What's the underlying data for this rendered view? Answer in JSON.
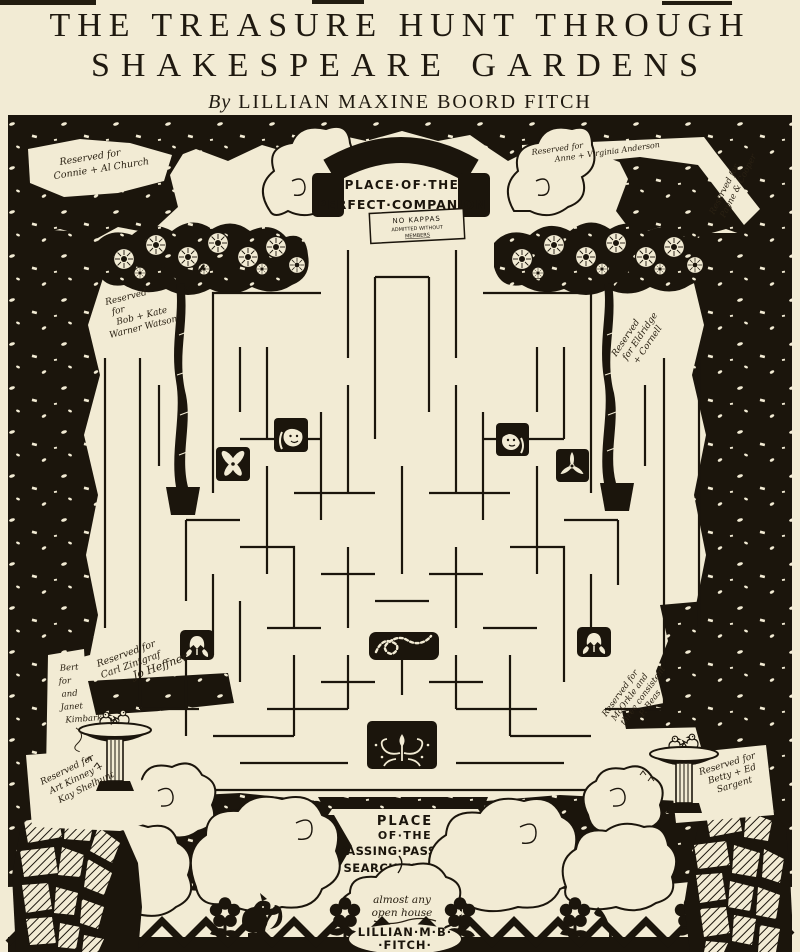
{
  "header": {
    "title_line1": "THE TREASURE HUNT THROUGH",
    "title_line2": "SHAKESPEARE GARDENS",
    "byline_prefix": "By",
    "byline_name": "LILLIAN MAXINE BOORD FITCH"
  },
  "garden": {
    "entrance": {
      "line1": "PLACE·OF·THE",
      "line2": "PERFECT·COMPANION",
      "sign_line1": "NO KAPPAS",
      "sign_line2": "ADMITTED WITHOUT",
      "sign_line3": "MEMBERS"
    },
    "exit": {
      "line1": "PLACE",
      "line2": "OF·THE",
      "line3": "PASSING·PASSION -",
      "line4": "SEARCH·FURTHER",
      "cloud_line1": "almost any",
      "cloud_line2": "open house",
      "signature_line1": "LILLIAN·M·B·",
      "signature_line2": "·FITCH·"
    },
    "annotations": {
      "top_left": {
        "l1": "Reserved for",
        "l2": "Connie + Al Church"
      },
      "top_right_inner": {
        "l1": "Reserved for",
        "l2": "Anne + Virginia Anderson"
      },
      "top_right_outer": {
        "l1": "Reserved for",
        "l2": "Payne & Cooper"
      },
      "left_tree": {
        "l1": "Reserved",
        "l2": "for",
        "l3": "Bob + Kate",
        "l4": "Warner Watson"
      },
      "right_tree": {
        "l1": "Reserved",
        "l2": "for Eldridge",
        "l3": "+ Cornell"
      },
      "mid_left": {
        "l1": "Reserved for",
        "l2": "Carl Zintgraf",
        "l3": "Jo Heffner"
      },
      "far_left": {
        "l1": "Bert",
        "l2": "for",
        "l3": "and",
        "l4": "Janet",
        "l5": "Kimbark"
      },
      "mid_right": {
        "l1": "Reserved for",
        "l2": "McOrkle and",
        "l3": "three consistent",
        "l4": "P. Beas"
      },
      "bottom_left": {
        "l1": "Reserved for",
        "l2": "Art Kinney +",
        "l3": "Kay Shelhunt"
      },
      "bottom_right": {
        "l1": "Reserved for",
        "l2": "Betty + Ed",
        "l3": "Sargent"
      }
    },
    "icons": [
      "hedge-border",
      "entrance-arch",
      "cloud",
      "left-tree",
      "right-tree",
      "maze",
      "girl-face-medallion",
      "boy-face-medallion",
      "orchid-medallion",
      "trillium-medallion",
      "tulip-medallion",
      "caterpillar-medallion",
      "flourish-medallion",
      "birdbath",
      "stone-path",
      "arrow-up",
      "squirrel",
      "flower-border"
    ],
    "colors": {
      "paper": "#f2ebd4",
      "ink": "#1b150c"
    }
  }
}
